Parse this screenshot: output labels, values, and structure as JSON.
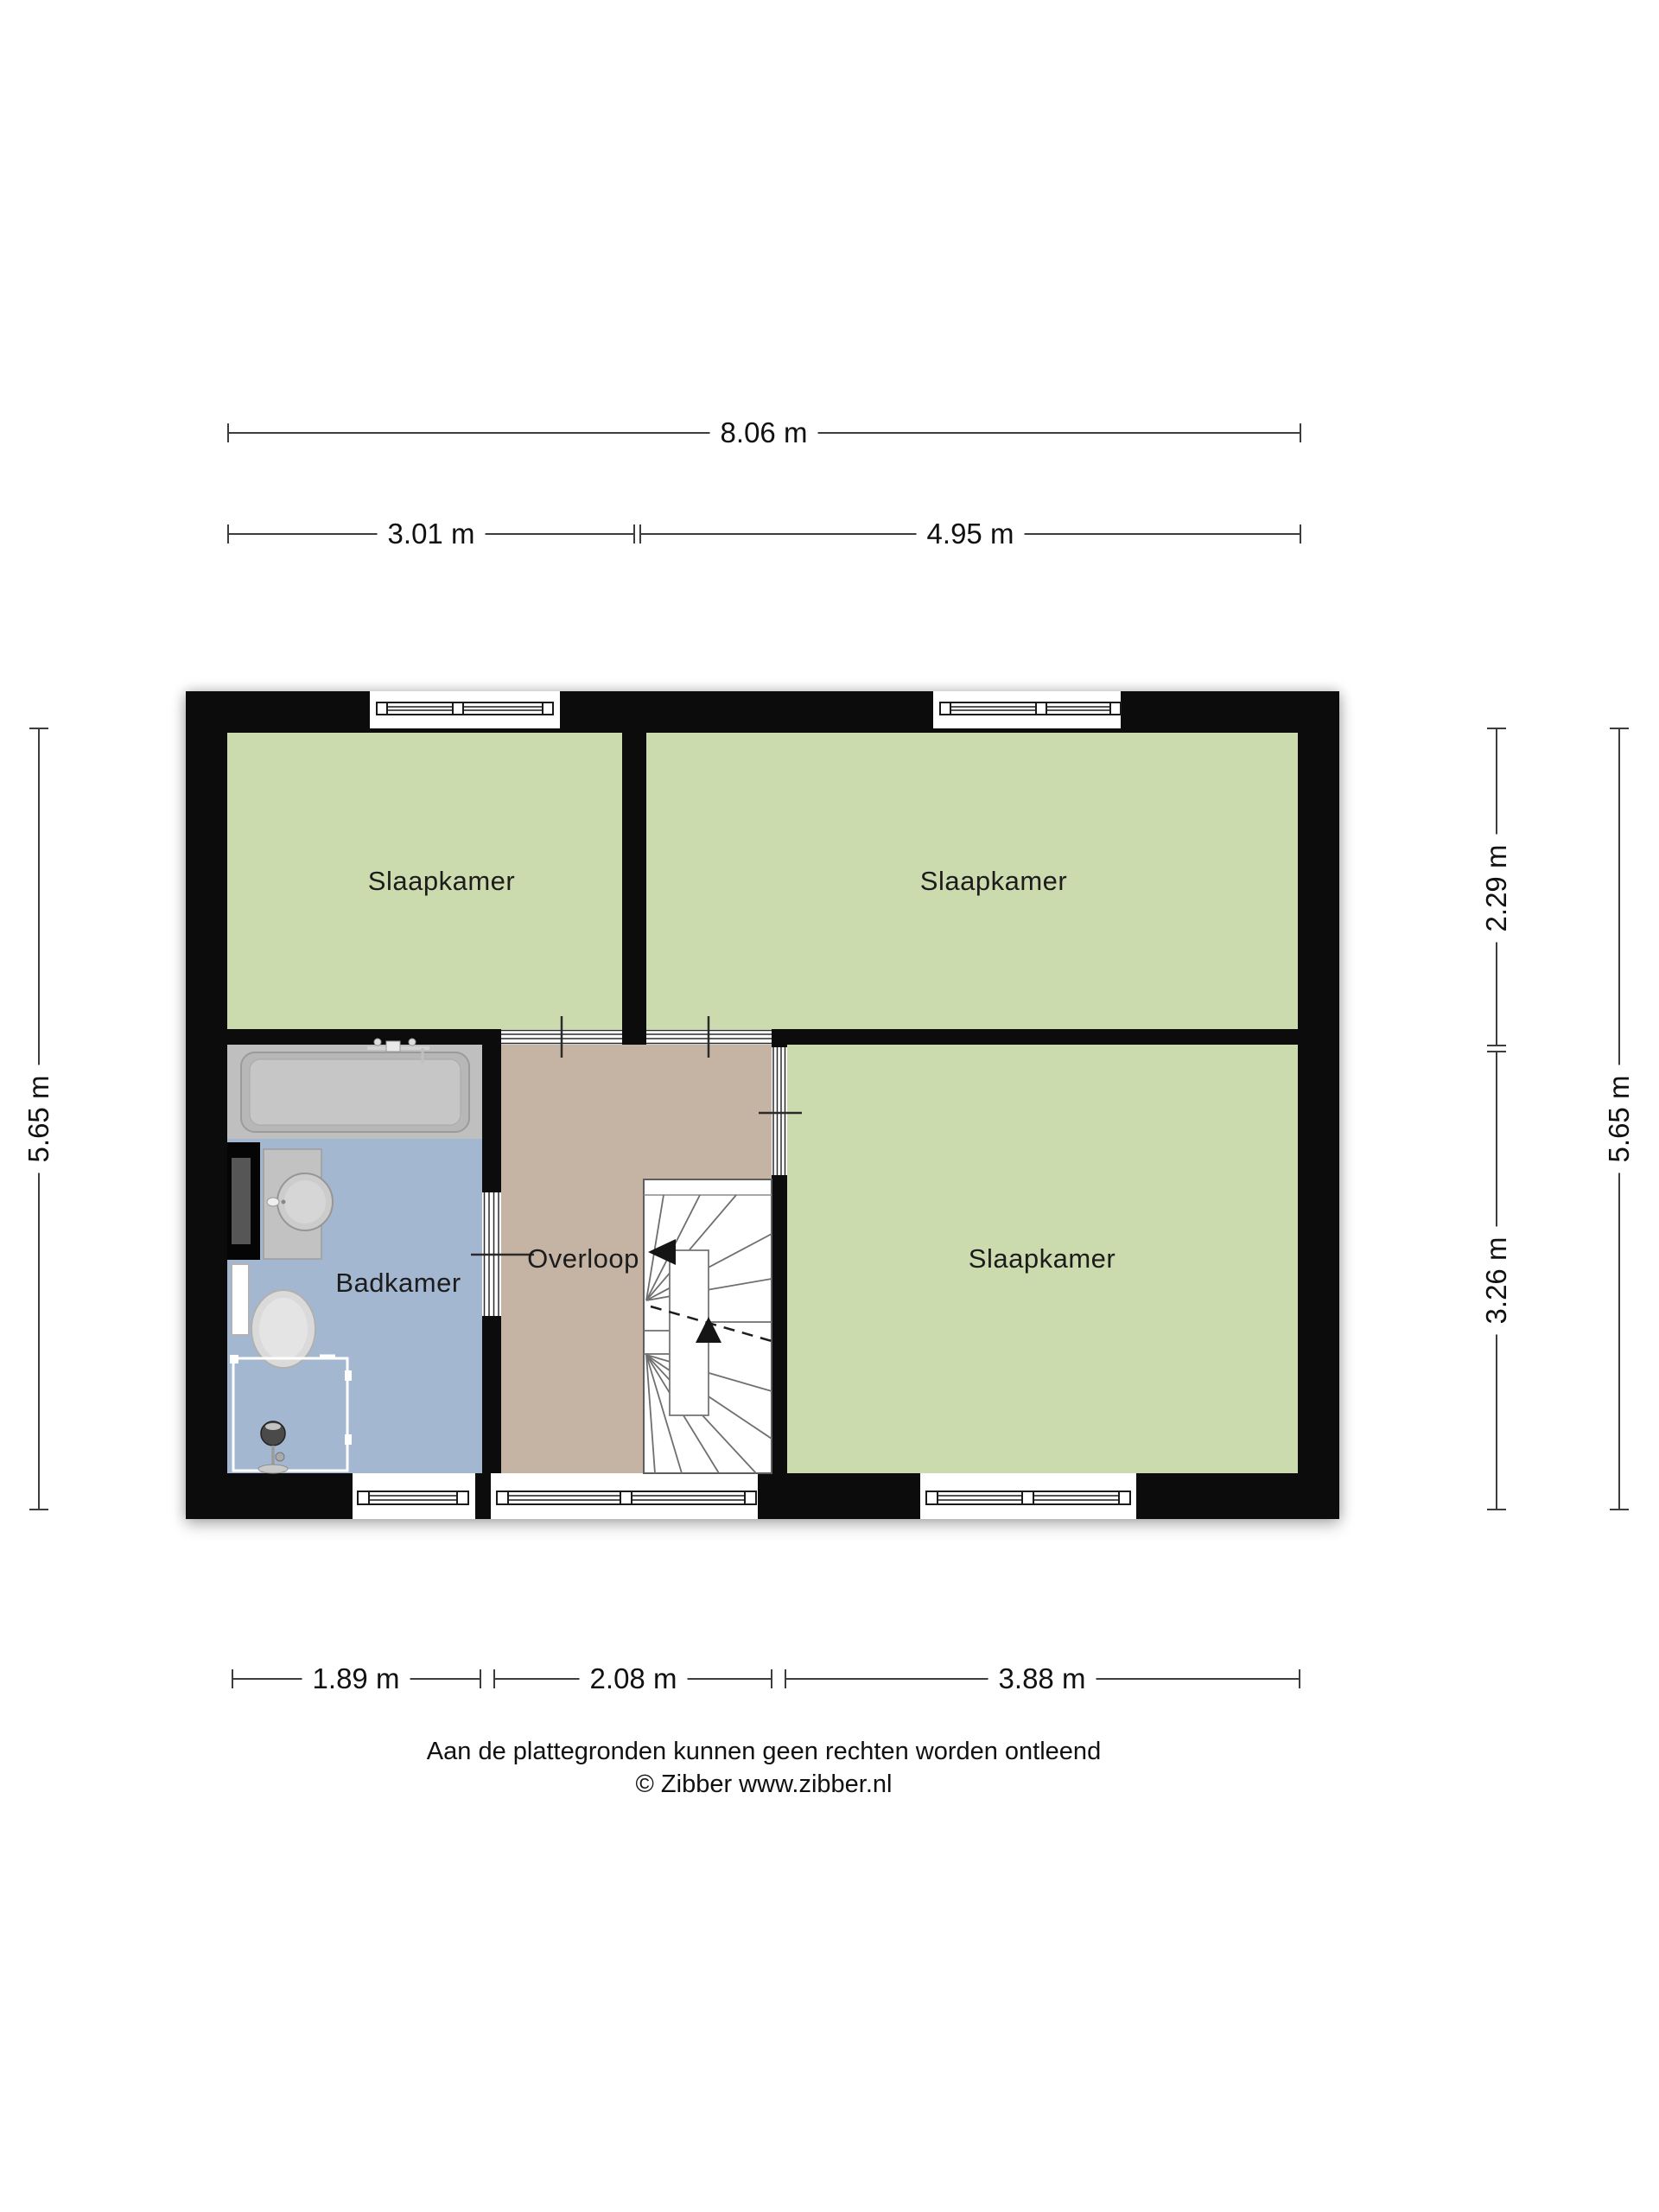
{
  "floorplan": {
    "title": "Eerste verdieping plattegrond",
    "rooms": [
      {
        "name": "bedroom-top-left",
        "label": "Slaapkamer"
      },
      {
        "name": "bedroom-top-right",
        "label": "Slaapkamer"
      },
      {
        "name": "bedroom-bottom-right",
        "label": "Slaapkamer"
      },
      {
        "name": "bathroom",
        "label": "Badkamer"
      },
      {
        "name": "landing",
        "label": "Overloop"
      }
    ],
    "colors": {
      "bedroom_green": "#cbdbae",
      "landing_brown": "#c5b4a3",
      "bathroom_blue": "#a4b7d0",
      "wall_black": "#0c0c0c",
      "fixture_gray": "#bfbfbf"
    }
  },
  "dimensions": {
    "top_total": {
      "label": "8.06 m"
    },
    "top_left": {
      "label": "3.01 m"
    },
    "top_right": {
      "label": "4.95 m"
    },
    "bottom_left": {
      "label": "1.89 m"
    },
    "bottom_middle": {
      "label": "2.08 m"
    },
    "bottom_right": {
      "label": "3.88 m"
    },
    "left_total": {
      "label": "5.65 m"
    },
    "right_top": {
      "label": "2.29 m"
    },
    "right_bottom": {
      "label": "3.26 m"
    },
    "right_total": {
      "label": "5.65 m"
    }
  },
  "footer": {
    "line1": "Aan de plattegronden kunnen geen rechten worden ontleend",
    "line2": "© Zibber www.zibber.nl"
  }
}
